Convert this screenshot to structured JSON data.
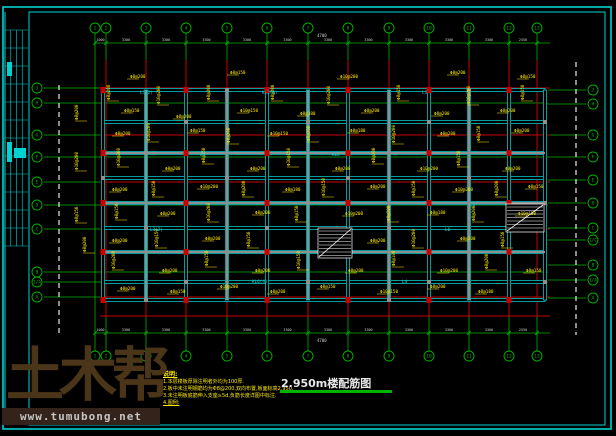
{
  "colors": {
    "background": "#000000",
    "frame_cyan": "#00d2d2",
    "axis_green": "#00b400",
    "axis_red": "#c80000",
    "beam_cyan": "#00e0e0",
    "column_gray": "#8f8f8f",
    "rebar_yellow": "#ffe900",
    "dim_text": "#cfcfcf",
    "stair_white": "#ffffff",
    "watermark_brown": "#4a3518",
    "watermark_site_gray": "#c4c4c4"
  },
  "watermark": {
    "logo": "土木帮",
    "site": "www.tumubong.net"
  },
  "drawing_title": {
    "text": "2.950m楼配筋图"
  },
  "notes": {
    "heading": "说明:",
    "lines": [
      "1.本层楼板厚除注明者外均为100厚.",
      "2.板中未注明钢筋均为Φ8@200,双向布置,板面标高2.950.",
      "3.未注明板底筋伸入支座≥5d,负筋长度详图中标注.",
      "4.图例:"
    ]
  },
  "axes": {
    "top": {
      "cy": 28,
      "cx_list": [
        95,
        106,
        146,
        186,
        227,
        267,
        308,
        348,
        389,
        429,
        469,
        509,
        537
      ],
      "labels": [
        "1",
        "2",
        "3",
        "4",
        "5",
        "6",
        "7",
        "8",
        "9",
        "10",
        "11",
        "12",
        "13"
      ]
    },
    "bottom": {
      "cy": 356,
      "cx_list": [
        95,
        106,
        146,
        186,
        227,
        267,
        308,
        348,
        389,
        429,
        469,
        509,
        537
      ],
      "labels": [
        "1",
        "2",
        "3",
        "4",
        "5",
        "6",
        "7",
        "8",
        "9",
        "10",
        "11",
        "12",
        "13"
      ]
    },
    "left": {
      "cx": 37,
      "cy_list": [
        88,
        103,
        135,
        157,
        182,
        205,
        229,
        272,
        282,
        297
      ],
      "labels": [
        "J",
        "H",
        "G",
        "F",
        "E",
        "D",
        "C",
        "B",
        "1/A",
        "A"
      ]
    },
    "right": {
      "cx": 593,
      "cy_list": [
        90,
        104,
        135,
        157,
        180,
        203,
        228,
        240,
        265,
        280,
        298
      ],
      "labels": [
        "J",
        "H",
        "G",
        "F",
        "E",
        "D",
        "C",
        "1/C",
        "B",
        "1/A",
        "A"
      ]
    }
  },
  "dimensions": {
    "top": {
      "y": 43,
      "values": [
        "1000",
        "3300",
        "3300",
        "3300",
        "3300",
        "3300",
        "3300",
        "3300",
        "3300",
        "3300",
        "3300",
        "2550"
      ]
    },
    "bottom": {
      "y": 333,
      "values": [
        "1000",
        "3300",
        "3300",
        "3300",
        "3300",
        "3300",
        "3300",
        "3300",
        "3300",
        "3300",
        "3300",
        "2550"
      ]
    },
    "stray_labels": [
      {
        "x": 317,
        "y": 37,
        "text": "4700"
      },
      {
        "x": 317,
        "y": 342,
        "text": "4700"
      }
    ]
  },
  "plan": {
    "x0": 103,
    "x1": 545,
    "y0": 90,
    "y1": 300,
    "beam_rows": [
      90,
      122,
      153,
      178,
      203,
      228,
      252,
      282,
      300
    ],
    "beam_cols": [
      103,
      146,
      186,
      227,
      267,
      308,
      348,
      389,
      429,
      469,
      509,
      545
    ],
    "gray_rows": [
      153,
      203,
      252
    ],
    "gray_cols": [
      146,
      227,
      308,
      389,
      469
    ],
    "red_rows": [
      88,
      135,
      182,
      229,
      297,
      316
    ],
    "red_cols": [
      106,
      146,
      186,
      227,
      267,
      308,
      348,
      389,
      429,
      469,
      509,
      537
    ],
    "dashed_lines": [
      {
        "x": 59,
        "y0": 85,
        "y1": 335
      },
      {
        "x": 576,
        "y0": 62,
        "y1": 335
      }
    ]
  },
  "stairs": [
    {
      "x": 318,
      "y": 228,
      "w": 34,
      "h": 30
    },
    {
      "x": 506,
      "y": 204,
      "w": 38,
      "h": 28
    }
  ],
  "beam_labels": [
    [
      140,
      94,
      "L1(2)"
    ],
    [
      262,
      94,
      "KL2(6)"
    ],
    [
      422,
      94,
      "L1"
    ],
    [
      200,
      156,
      "L5"
    ],
    [
      332,
      156,
      "KL5"
    ],
    [
      470,
      206,
      "L2"
    ],
    [
      150,
      231,
      "L3(2)"
    ],
    [
      445,
      231,
      "L6"
    ],
    [
      252,
      283,
      "KL6(4)"
    ],
    [
      402,
      283,
      "L4"
    ]
  ],
  "annotations": [
    [
      110,
      100,
      "Φ8@200",
      1
    ],
    [
      124,
      112,
      "Φ8@150",
      0
    ],
    [
      160,
      104,
      "Φ10@200",
      1
    ],
    [
      176,
      118,
      "Φ8@200",
      0
    ],
    [
      210,
      100,
      "Φ8@200",
      1
    ],
    [
      240,
      112,
      "Φ10@150",
      0
    ],
    [
      274,
      100,
      "Φ8@200",
      1
    ],
    [
      300,
      115,
      "Φ8@180",
      0
    ],
    [
      330,
      104,
      "Φ10@200",
      1
    ],
    [
      364,
      112,
      "Φ8@200",
      0
    ],
    [
      400,
      100,
      "Φ8@150",
      1
    ],
    [
      434,
      115,
      "Φ8@200",
      0
    ],
    [
      470,
      104,
      "Φ10@200",
      1
    ],
    [
      500,
      112,
      "Φ8@200",
      0
    ],
    [
      524,
      100,
      "Φ8@150",
      1
    ],
    [
      115,
      135,
      "Φ8@200",
      0
    ],
    [
      150,
      141,
      "Φ10@200",
      1
    ],
    [
      190,
      132,
      "Φ8@150",
      0
    ],
    [
      230,
      143,
      "Φ8@200",
      1
    ],
    [
      270,
      135,
      "Φ10@150",
      0
    ],
    [
      310,
      141,
      "Φ8@200",
      1
    ],
    [
      350,
      132,
      "Φ8@180",
      0
    ],
    [
      395,
      143,
      "Φ10@200",
      1
    ],
    [
      440,
      135,
      "Φ8@200",
      0
    ],
    [
      480,
      141,
      "Φ8@150",
      1
    ],
    [
      514,
      132,
      "Φ8@200",
      0
    ],
    [
      120,
      166,
      "Φ10@200",
      1
    ],
    [
      165,
      170,
      "Φ8@200",
      0
    ],
    [
      205,
      163,
      "Φ8@150",
      1
    ],
    [
      250,
      170,
      "Φ8@200",
      0
    ],
    [
      290,
      166,
      "Φ10@150",
      1
    ],
    [
      335,
      170,
      "Φ8@200",
      0
    ],
    [
      375,
      163,
      "Φ8@200",
      1
    ],
    [
      420,
      170,
      "Φ10@200",
      0
    ],
    [
      460,
      166,
      "Φ8@150",
      1
    ],
    [
      505,
      170,
      "Φ8@200",
      0
    ],
    [
      112,
      191,
      "Φ8@200",
      0
    ],
    [
      155,
      196,
      "Φ8@150",
      1
    ],
    [
      200,
      188,
      "Φ10@200",
      0
    ],
    [
      245,
      196,
      "Φ8@200",
      1
    ],
    [
      285,
      191,
      "Φ8@180",
      0
    ],
    [
      325,
      196,
      "Φ10@150",
      1
    ],
    [
      370,
      188,
      "Φ8@200",
      0
    ],
    [
      415,
      196,
      "Φ8@150",
      1
    ],
    [
      455,
      191,
      "Φ10@200",
      0
    ],
    [
      498,
      196,
      "Φ8@200",
      1
    ],
    [
      528,
      188,
      "Φ8@150",
      0
    ],
    [
      118,
      219,
      "Φ8@150",
      1
    ],
    [
      160,
      215,
      "Φ8@200",
      0
    ],
    [
      210,
      221,
      "Φ10@200",
      1
    ],
    [
      255,
      214,
      "Φ8@200",
      0
    ],
    [
      298,
      221,
      "Φ8@150",
      1
    ],
    [
      345,
      215,
      "Φ10@200",
      0
    ],
    [
      390,
      221,
      "Φ8@200",
      1
    ],
    [
      430,
      214,
      "Φ8@180",
      0
    ],
    [
      475,
      221,
      "Φ8@200",
      1
    ],
    [
      518,
      215,
      "Φ10@150",
      0
    ],
    [
      112,
      242,
      "Φ8@200",
      0
    ],
    [
      158,
      247,
      "Φ10@150",
      1
    ],
    [
      205,
      240,
      "Φ8@200",
      0
    ],
    [
      250,
      247,
      "Φ8@150",
      1
    ],
    [
      370,
      242,
      "Φ8@200",
      0
    ],
    [
      415,
      247,
      "Φ10@200",
      1
    ],
    [
      460,
      240,
      "Φ8@200",
      0
    ],
    [
      504,
      247,
      "Φ8@150",
      1
    ],
    [
      115,
      269,
      "Φ10@200",
      1
    ],
    [
      162,
      272,
      "Φ8@200",
      0
    ],
    [
      208,
      266,
      "Φ8@150",
      1
    ],
    [
      255,
      272,
      "Φ8@200",
      0
    ],
    [
      300,
      269,
      "Φ10@150",
      1
    ],
    [
      348,
      272,
      "Φ8@200",
      0
    ],
    [
      395,
      266,
      "Φ8@180",
      1
    ],
    [
      440,
      272,
      "Φ10@200",
      0
    ],
    [
      488,
      269,
      "Φ8@200",
      1
    ],
    [
      526,
      272,
      "Φ8@150",
      0
    ],
    [
      120,
      290,
      "Φ8@200",
      0
    ],
    [
      170,
      293,
      "Φ8@150",
      0
    ],
    [
      220,
      288,
      "Φ10@200",
      0
    ],
    [
      270,
      293,
      "Φ8@200",
      0
    ],
    [
      320,
      288,
      "Φ8@150",
      0
    ],
    [
      380,
      293,
      "Φ10@150",
      0
    ],
    [
      430,
      288,
      "Φ8@200",
      0
    ],
    [
      478,
      293,
      "Φ8@180",
      0
    ],
    [
      78,
      120,
      "Φ8@200",
      1
    ],
    [
      78,
      170,
      "Φ10@200",
      1
    ],
    [
      78,
      222,
      "Φ8@150",
      1
    ],
    [
      86,
      252,
      "Φ8@200",
      1
    ],
    [
      130,
      78,
      "Φ8@200",
      0
    ],
    [
      230,
      74,
      "Φ8@150",
      0
    ],
    [
      340,
      78,
      "Φ10@200",
      0
    ],
    [
      450,
      74,
      "Φ8@200",
      0
    ],
    [
      520,
      78,
      "Φ8@150",
      0
    ]
  ],
  "titleblock": {
    "x": 5,
    "y": 30,
    "w": 23,
    "h": 216,
    "cols": 4,
    "rows": 12
  }
}
